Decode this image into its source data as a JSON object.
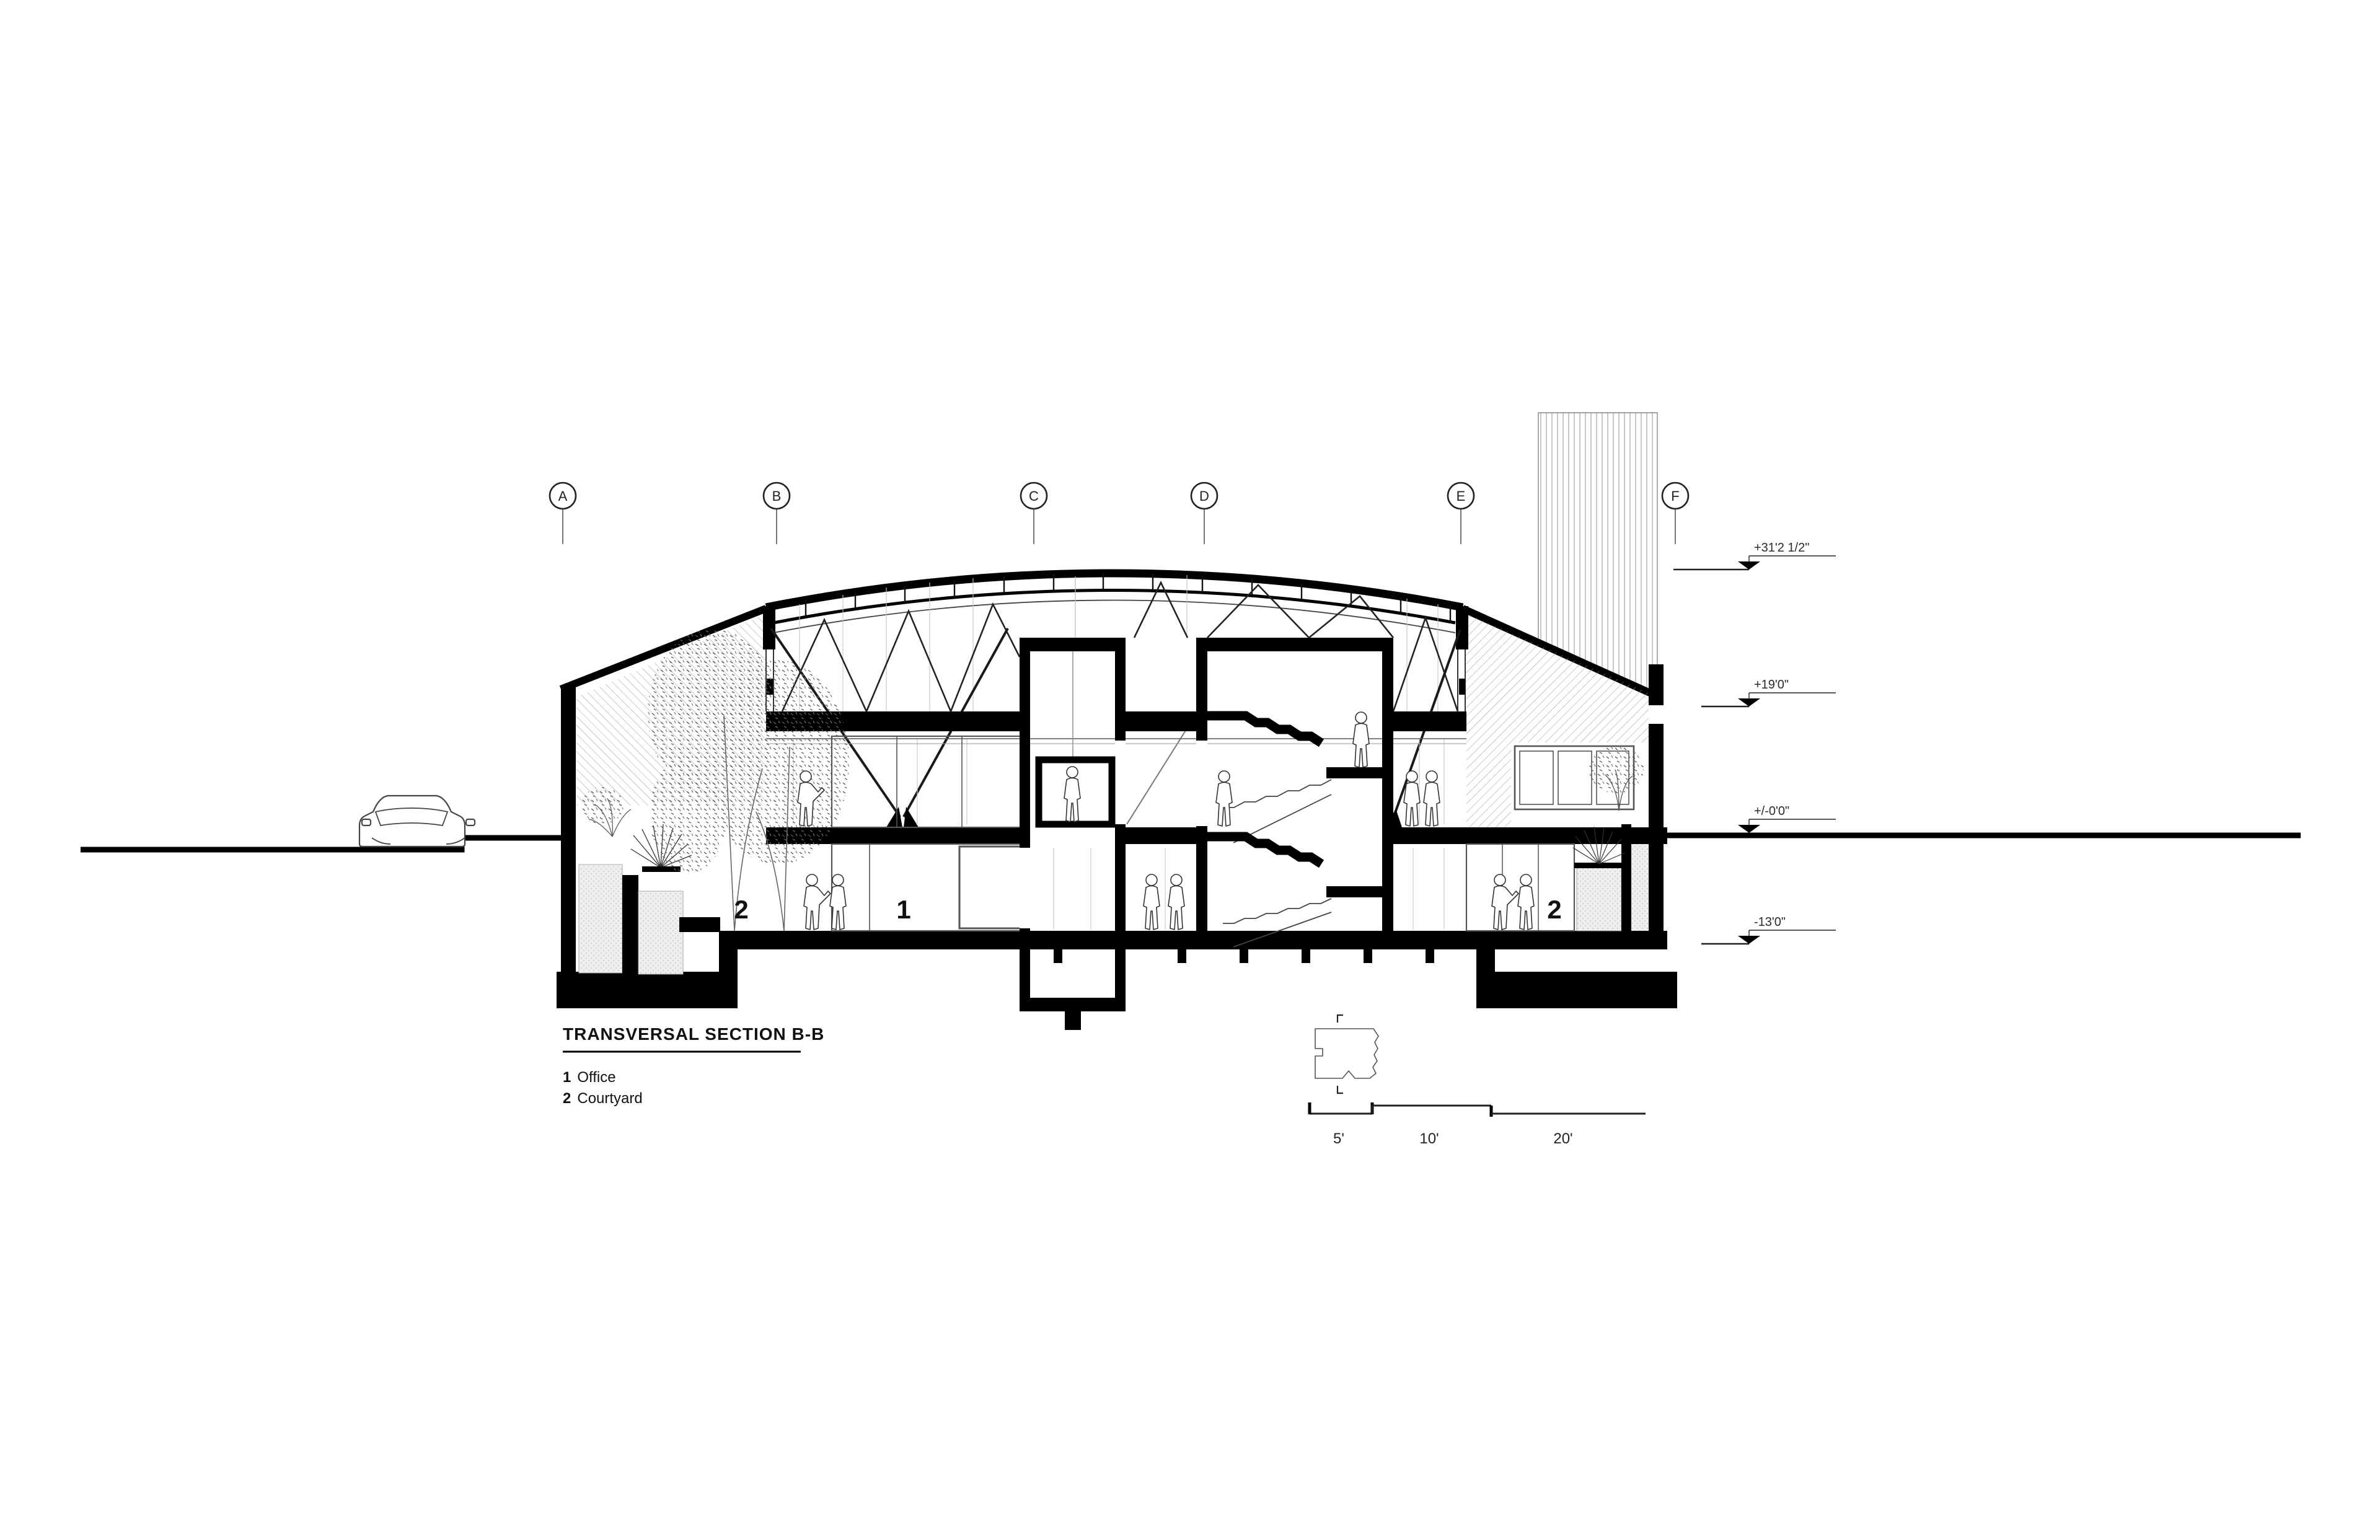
{
  "title_block": {
    "title": "TRANSVERSAL SECTION B-B",
    "legend": [
      {
        "num": "1",
        "label": "Office"
      },
      {
        "num": "2",
        "label": "Courtyard"
      }
    ]
  },
  "grid_markers": [
    {
      "label": "A"
    },
    {
      "label": "B"
    },
    {
      "label": "C"
    },
    {
      "label": "D"
    },
    {
      "label": "E"
    },
    {
      "label": "F"
    }
  ],
  "elevation_markers": [
    {
      "label": "+31'2 1/2\""
    },
    {
      "label": "+19'0\""
    },
    {
      "label": "+/-0'0\""
    },
    {
      "label": "-13'0\""
    }
  ],
  "scale_bar": {
    "segments": [
      "5'",
      "10'",
      "20'"
    ]
  },
  "room_labels": [
    {
      "num": "2",
      "name": "Courtyard"
    },
    {
      "num": "1",
      "name": "Office"
    },
    {
      "num": "2",
      "name": "Courtyard"
    }
  ],
  "colors": {
    "ink": "#000000",
    "hatch": "#9a9a9a",
    "light_line": "#c6c6c6",
    "planter_fill": "#ededed"
  }
}
